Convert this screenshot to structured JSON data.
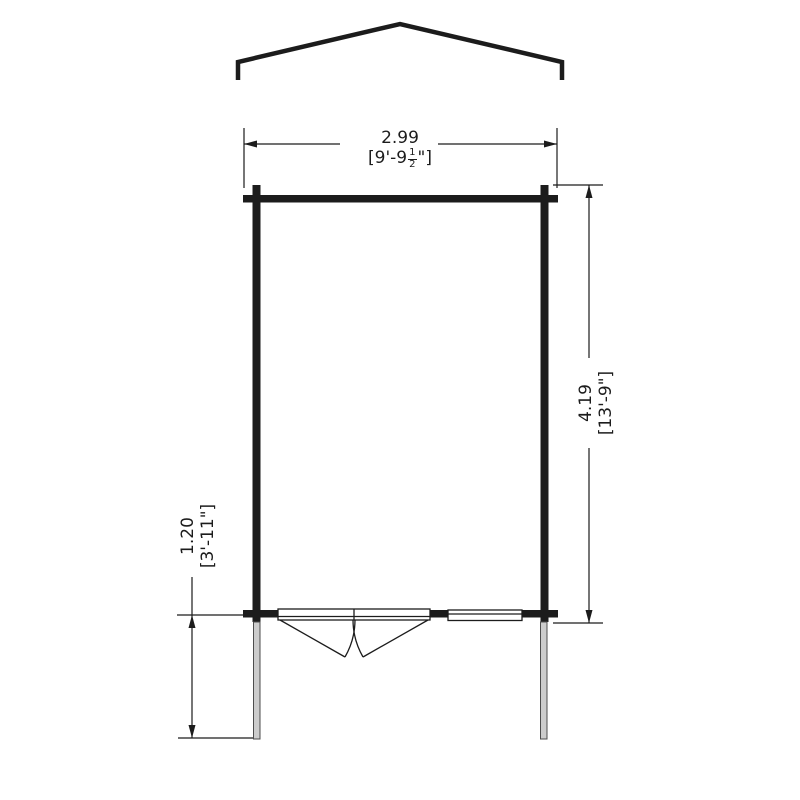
{
  "drawing": {
    "kind": "cabin floor plan elevation outline",
    "dimensions": {
      "width": {
        "metric": "2.99",
        "imperial_prefix": "[9'-9",
        "frac_num": "1",
        "frac_den": "2",
        "imperial_suffix": "\"]"
      },
      "depth": {
        "metric": "4.19",
        "imperial": "[13'-9\"]"
      },
      "porch_depth": {
        "metric": "1.20",
        "imperial": "[3'-11\"]"
      }
    },
    "colors": {
      "line": "#1c1c1c",
      "post_fill": "#cccccc",
      "post_outline": "#4d4d4d",
      "background": "#ffffff"
    }
  }
}
